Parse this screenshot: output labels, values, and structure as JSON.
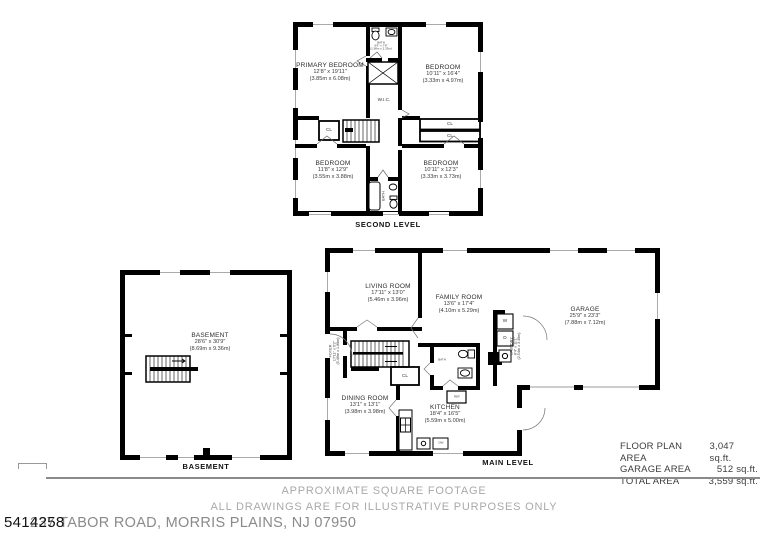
{
  "document": {
    "mls_number": "5414258",
    "address": "237 TABOR ROAD, MORRIS PLAINS, NJ 07950",
    "disclaimer_line1": "APPROXIMATE SQUARE FOOTAGE",
    "disclaimer_line2": "ALL DRAWINGS ARE FOR ILLUSTRATIVE PURPOSES ONLY"
  },
  "area_summary": {
    "floor_plan": {
      "label": "FLOOR PLAN AREA",
      "value": "3,047 sq.ft."
    },
    "garage": {
      "label": "GARAGE AREA",
      "value": "512 sq.ft."
    },
    "total": {
      "label": "TOTAL AREA",
      "value": "3,559 sq.ft."
    }
  },
  "second_level": {
    "caption": "SECOND LEVEL",
    "primary_bedroom": {
      "name": "PRIMARY BEDROOM",
      "imperial": "12'8\" x 19'11\"",
      "metric": "(3.85m x 6.08m)"
    },
    "bedroom_top_right": {
      "name": "BEDROOM",
      "imperial": "10'11\" x 16'4\"",
      "metric": "(3.33m x 4.97m)"
    },
    "bedroom_bottom_left": {
      "name": "BEDROOM",
      "imperial": "11'8\" x 12'9\"",
      "metric": "(3.55m x 3.88m)"
    },
    "bedroom_bottom_right": {
      "name": "BEDROOM",
      "imperial": "10'11\" x 12'3\"",
      "metric": "(3.33m x 3.73m)"
    },
    "bath_top": {
      "name": "BATH",
      "imperial": "6'6\" x 7'8\"",
      "metric": "(1.98m x 2.33m)"
    },
    "bath_bottom": {
      "name": "BATH"
    },
    "wic": "W.I.C.",
    "cl": "CL"
  },
  "main_level": {
    "caption": "MAIN LEVEL",
    "living_room": {
      "name": "LIVING ROOM",
      "imperial": "17'11\" x 13'0\"",
      "metric": "(5.46m x 3.96m)"
    },
    "family_room": {
      "name": "FAMILY ROOM",
      "imperial": "13'6\" x 17'4\"",
      "metric": "(4.10m x 5.29m)"
    },
    "garage": {
      "name": "GARAGE",
      "imperial": "25'9\" x 23'3\"",
      "metric": "(7.88m x 7.12m)"
    },
    "dining_room": {
      "name": "DINING ROOM",
      "imperial": "13'1\" x 13'1\"",
      "metric": "(3.98m x 3.98m)"
    },
    "kitchen": {
      "name": "KITCHEN",
      "imperial": "18'4\" x 16'5\"",
      "metric": "(5.59m x 5.00m)"
    },
    "foyer": {
      "name": "FOYER",
      "imperial": "17'11\" x 6'2\"",
      "metric": "(5.46m x 1.88m)"
    },
    "laundry": {
      "name": "LAUNDRY",
      "imperial": "8'4\" x 11'1\"",
      "metric": "(2.54m x 3.38m)"
    },
    "bath": "BATH",
    "washer": "W",
    "dryer": "D",
    "fridge": "REF",
    "dishwasher": "DW",
    "cl": "CL"
  },
  "basement": {
    "caption": "BASEMENT",
    "room": {
      "name": "BASEMENT",
      "imperial": "28'6\" x 30'9\"",
      "metric": "(8.69m x 9.36m)"
    }
  },
  "colors": {
    "wall": "#000000",
    "plan_text": "#2d2d2d",
    "footer_text": "#a9a9a9",
    "address_text": "#8a8a8a",
    "divider": "#8a8a8a"
  }
}
